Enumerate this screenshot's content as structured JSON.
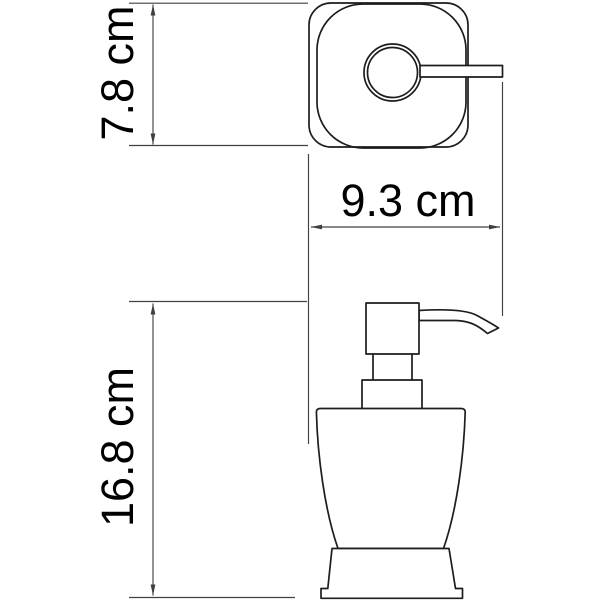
{
  "colors": {
    "background": "#ffffff",
    "line": "#1d1d1b",
    "dim": "#404040",
    "text": "#000000"
  },
  "drawing": {
    "subject": "soap-dispenser-technical-drawing",
    "unit": "cm"
  },
  "dimensions": {
    "depth": {
      "label": "7.8 cm",
      "value": 7.8,
      "unit": "cm"
    },
    "width": {
      "label": "9.3 cm",
      "value": 9.3,
      "unit": "cm"
    },
    "height": {
      "label": "16.8 cm",
      "value": 16.8,
      "unit": "cm"
    }
  }
}
